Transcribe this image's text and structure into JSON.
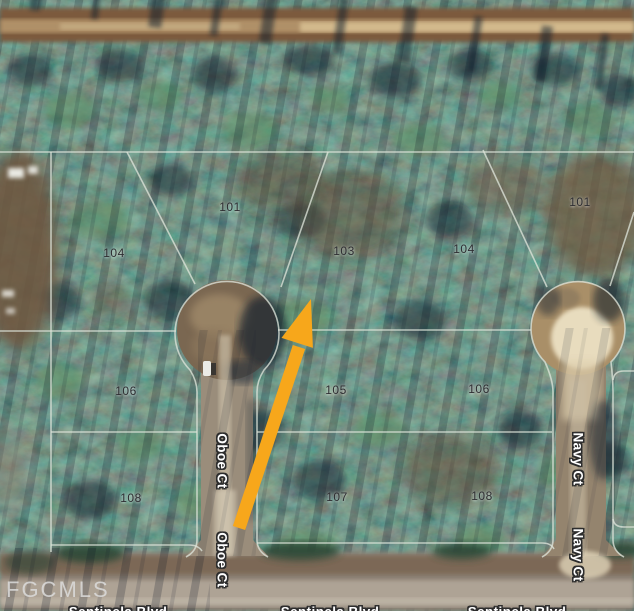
{
  "map": {
    "watermark": "FGCMLS",
    "arrow": {
      "color": "#F7A71B",
      "direction": "pointing-up-right"
    },
    "parcel_line_color": "#DDE3D9",
    "streets": {
      "oboe": "Oboe Ct",
      "navy": "Navy Ct",
      "sentinela": "Sentinela Blvd"
    },
    "lots": [
      {
        "number": "101"
      },
      {
        "number": "104"
      },
      {
        "number": "103"
      },
      {
        "number": "104"
      },
      {
        "number": "101"
      },
      {
        "number": "106"
      },
      {
        "number": "105"
      },
      {
        "number": "106"
      },
      {
        "number": "108"
      },
      {
        "number": "107"
      },
      {
        "number": "108"
      }
    ]
  }
}
